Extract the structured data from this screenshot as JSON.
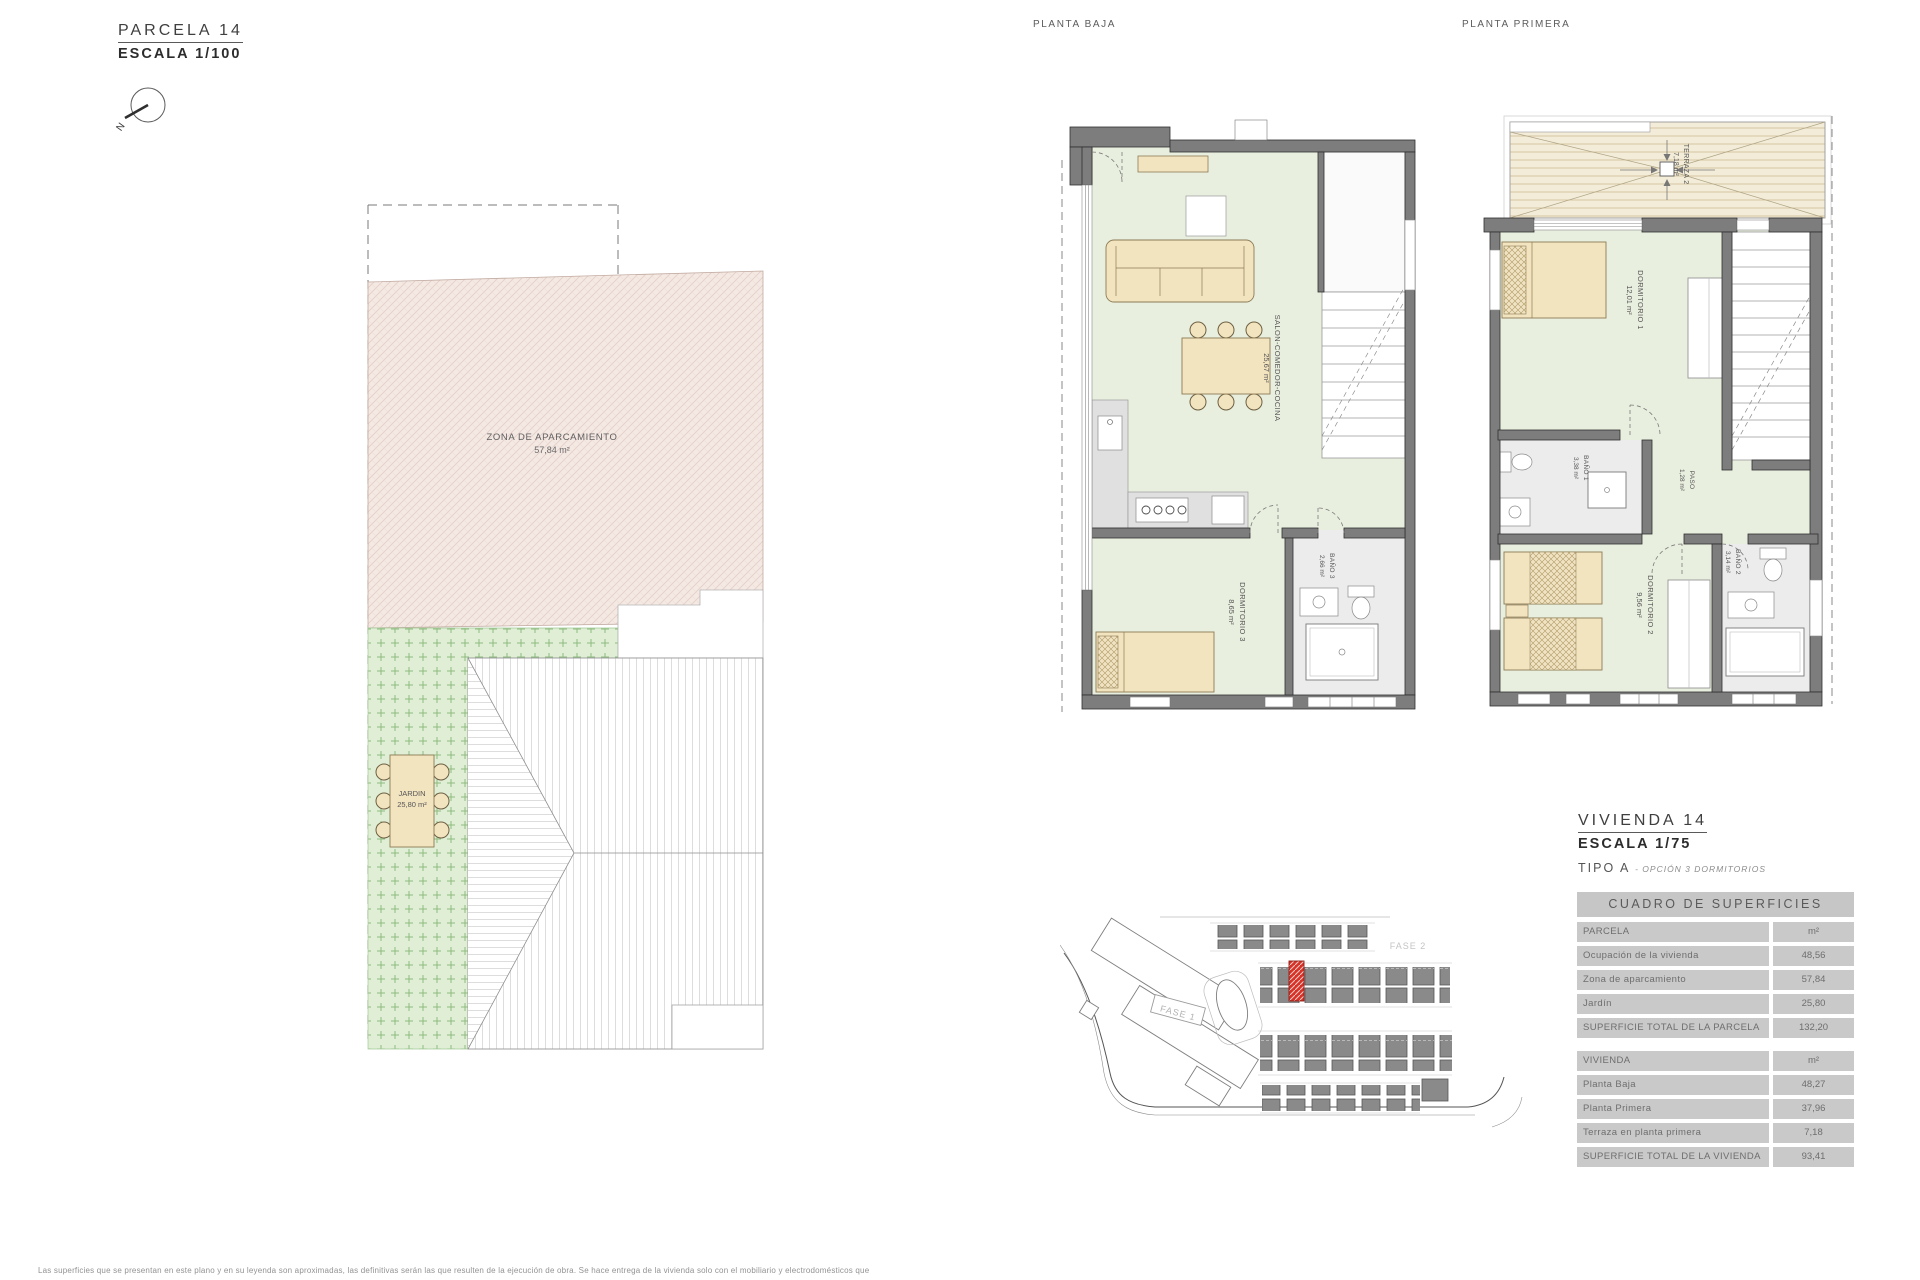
{
  "colors": {
    "accent_red": "#d63227",
    "wall_gray": "#7d7d7d",
    "floor_green": "#e9efdf",
    "parking_pink": "#f5e9e4",
    "garden_green": "#dfeed5",
    "terrace_tan": "#f3ecd8",
    "furniture_beige": "#f3e4c0",
    "table_gray": "#c9c9c9"
  },
  "parcel_header": {
    "title": "PARCELA 14",
    "scale": "ESCALA 1/100"
  },
  "compass": {
    "label": "N"
  },
  "parcel_plan": {
    "parking": {
      "name": "ZONA DE APARCAMIENTO",
      "area": "57,84 m²"
    },
    "garden": {
      "name": "JARDIN",
      "area": "25,80 m²"
    }
  },
  "planta_baja": {
    "title": "PLANTA BAJA",
    "salon": {
      "name": "SALON-COMEDOR-COCINA",
      "area": "25,67 m²"
    },
    "dormitorio3": {
      "name": "DORMITORIO 3",
      "area": "8,65 m²"
    },
    "bano3": {
      "name": "BAÑO 3",
      "area": "2,66 m²"
    }
  },
  "planta_primera": {
    "title": "PLANTA PRIMERA",
    "terraza": {
      "name": "TERRAZA 2",
      "area": "7,18 m²"
    },
    "dormitorio1": {
      "name": "DORMITORIO 1",
      "area": "12,01 m²"
    },
    "bano1": {
      "name": "BAÑO 1",
      "area": "3,38 m²"
    },
    "paso": {
      "name": "PASO",
      "area": "1,28 m²"
    },
    "dormitorio2": {
      "name": "DORMITORIO 2",
      "area": "9,56 m²"
    },
    "bano2": {
      "name": "BAÑO 2",
      "area": "3,14 m²"
    }
  },
  "vivienda_header": {
    "title": "VIVIENDA 14",
    "scale": "ESCALA 1/75",
    "tipo": "TIPO A",
    "tipo_detail": "- OPCIÓN 3 DORMITORIOS"
  },
  "site_plan": {
    "fase1": "FASE 1",
    "fase2": "FASE 2"
  },
  "surface_table": {
    "title": "CUADRO DE SUPERFICIES",
    "parcela_rows": [
      {
        "label": "PARCELA",
        "value": "m²"
      },
      {
        "label": "Ocupación de la vivienda",
        "value": "48,56"
      },
      {
        "label": "Zona de aparcamiento",
        "value": "57,84"
      },
      {
        "label": "Jardín",
        "value": "25,80"
      },
      {
        "label": "SUPERFICIE TOTAL DE LA PARCELA",
        "value": "132,20"
      }
    ],
    "vivienda_rows": [
      {
        "label": "VIVIENDA",
        "value": "m²"
      },
      {
        "label": "Planta Baja",
        "value": "48,27"
      },
      {
        "label": "Planta Primera",
        "value": "37,96"
      },
      {
        "label": "Terraza en planta primera",
        "value": "7,18"
      },
      {
        "label": "SUPERFICIE TOTAL DE LA VIVIENDA",
        "value": "93,41"
      }
    ]
  },
  "disclaimer": "Las superficies que se presentan en este plano y en su leyenda son aproximadas, las definitivas serán las que resulten de la ejecución de obra. Se hace entrega de la vivienda solo con el mobiliario y electrodomésticos que"
}
